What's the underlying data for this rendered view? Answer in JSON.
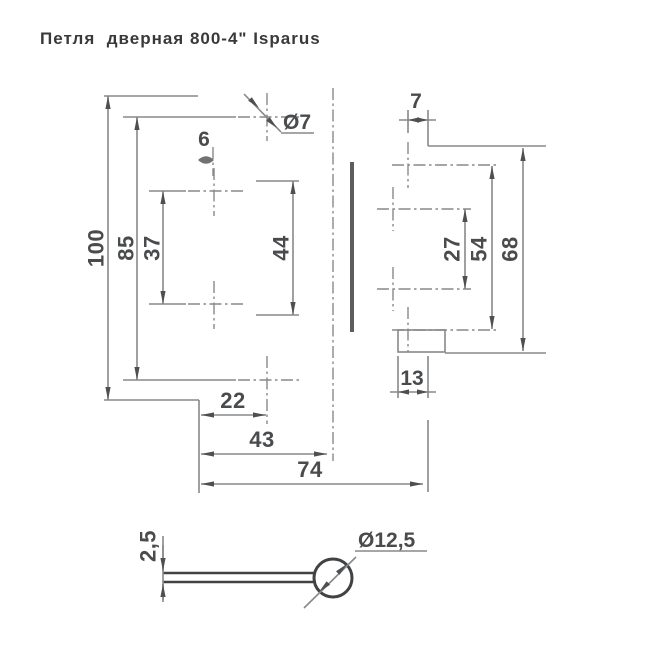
{
  "title": "Петля  дверная 800-4\" Isparus",
  "front": {
    "height": "100",
    "outer_hole_span": "85",
    "inner_hole_span": "37",
    "cutout_height": "44",
    "slot_width": "6",
    "hole_diameter": "Ø7",
    "edge_to_holes": "22",
    "edge_to_axis": "43",
    "overall_open_width": "74"
  },
  "leaf2": {
    "edge_to_hole": "7",
    "inner_hole_span": "27",
    "outer_hole_span": "54",
    "height": "68",
    "tab_width": "13"
  },
  "section": {
    "leaf_thickness": "2,5",
    "knuckle_diameter": "Ø12,5"
  },
  "colors": {
    "background": "#ffffff",
    "dimension_line": "#87888a",
    "arrow": "#4e4f51",
    "dimension_text": "#4a4b4d",
    "title_text": "#39393b",
    "outline_dark": "#414244"
  }
}
